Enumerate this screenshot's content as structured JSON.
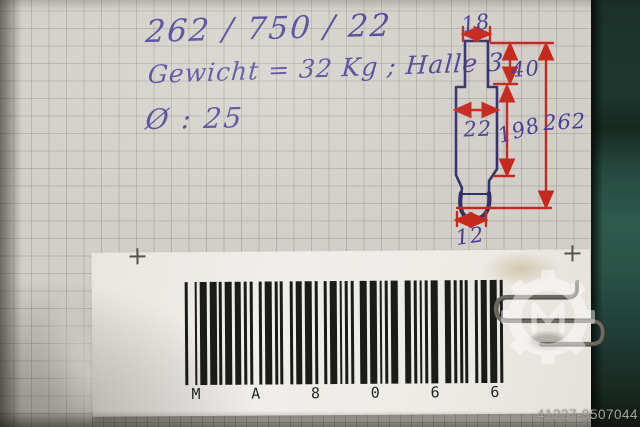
{
  "note_card": {
    "line1": "262 / 750 / 22",
    "line2": "Gewicht = 32 Kg ; Halle 3",
    "line3": "Ø : 25"
  },
  "sketch": {
    "dims": {
      "top_width": "18",
      "upper_height": "40",
      "body_width": "22",
      "body_height": "198",
      "total_height": "262",
      "tip_width": "12"
    }
  },
  "label": {
    "barcode_value": "MA8066",
    "chars": [
      "M",
      "A",
      "8",
      "0",
      "6",
      "6"
    ],
    "encoding": [
      "nwnnwnwnn",
      "wnwnnnnwn",
      "wnnnnwnnw",
      "wnnwnnwnn",
      "nnnwwnwnn",
      "nnwwwnnnn",
      "nnwwwnnnn",
      "nwnnwnwnn"
    ]
  },
  "watermark": {
    "id": "41227-9507044"
  },
  "colors": {
    "ink_blue": "#483e96",
    "ink_red": "#c5281c",
    "sketch_blue": "#34306a",
    "band_teal": "#2a4f44",
    "paper": "#d2cfc9"
  }
}
